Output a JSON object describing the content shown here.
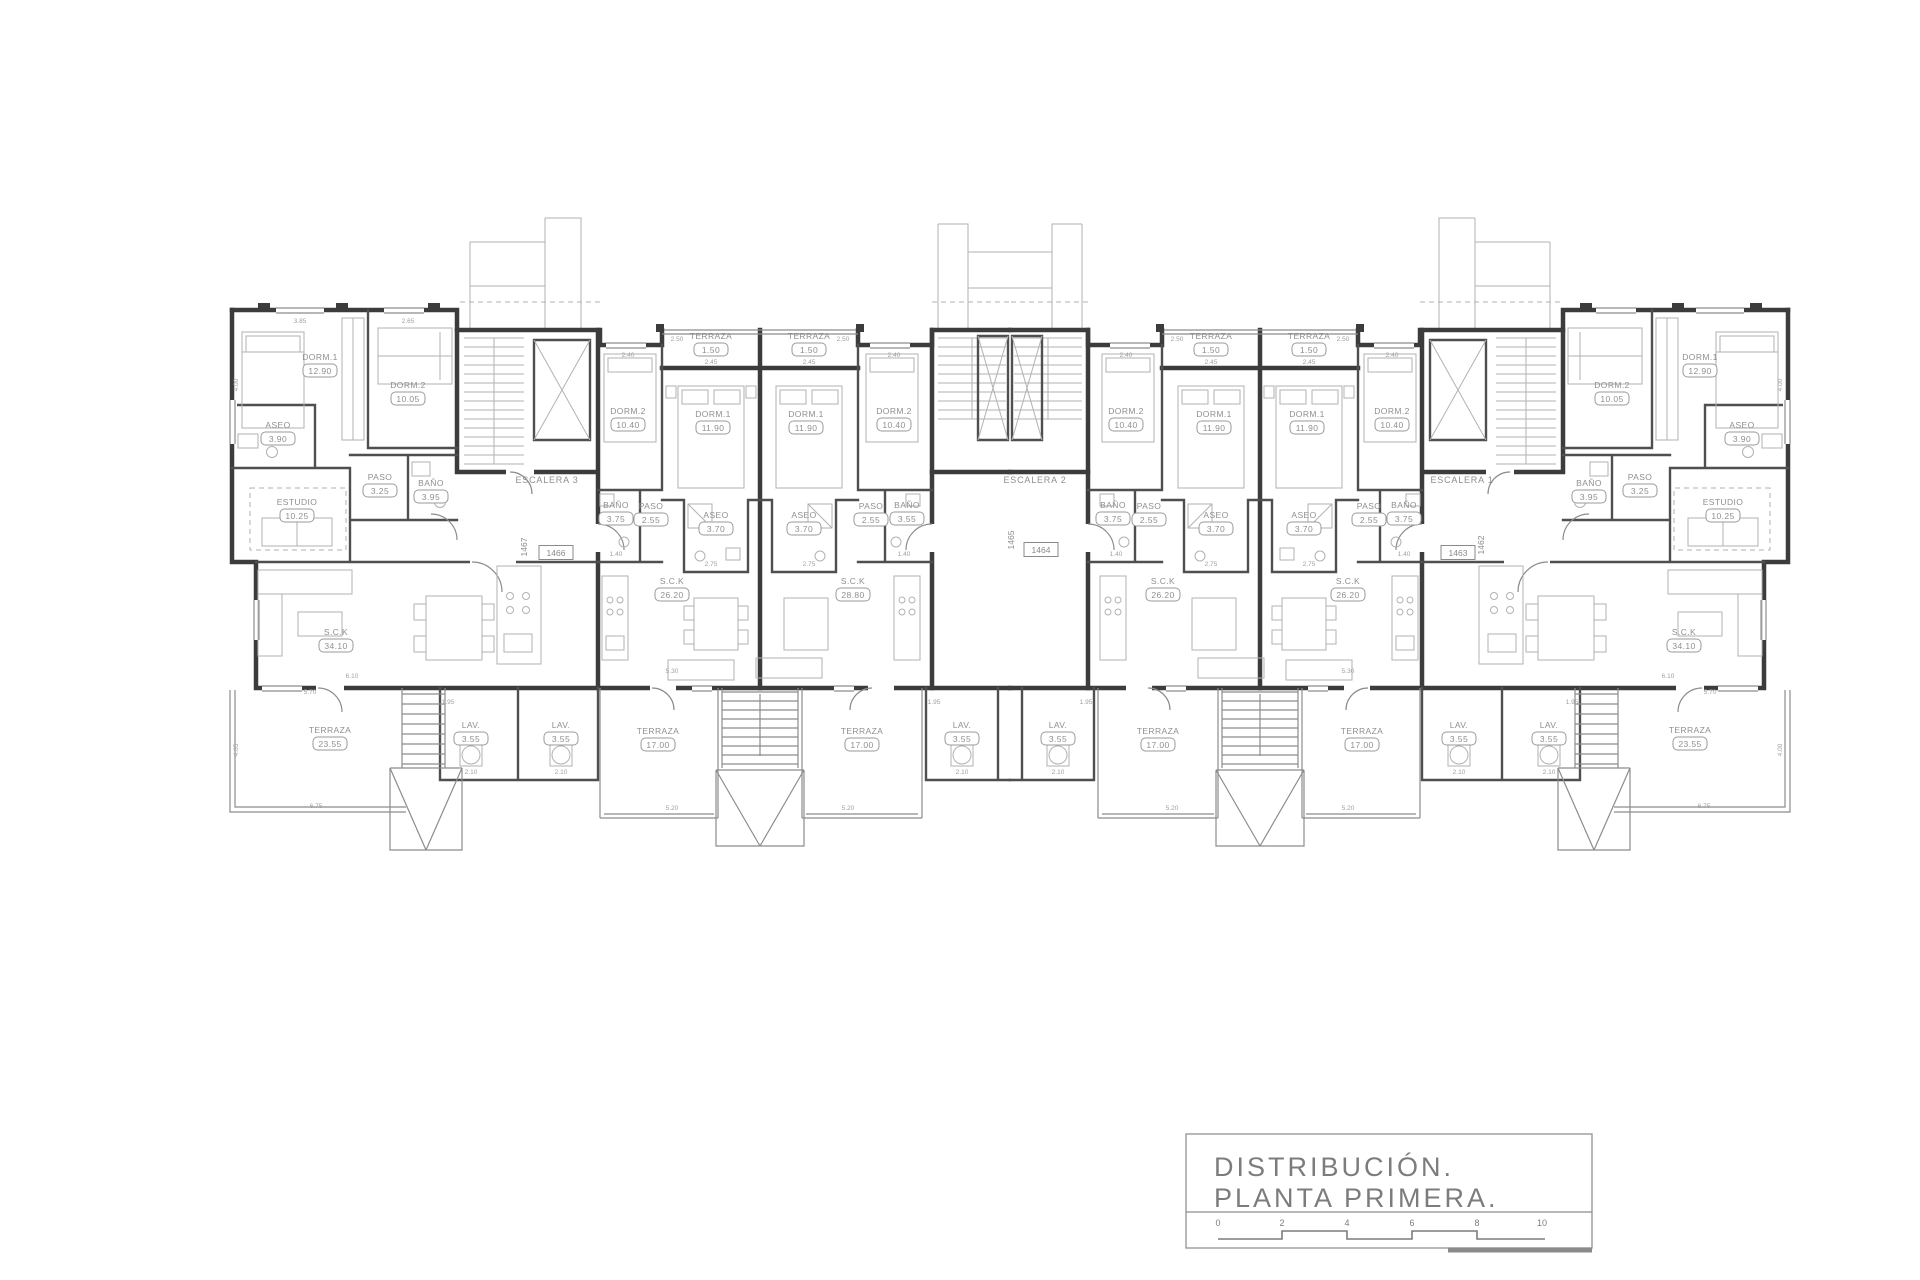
{
  "drawing": {
    "title": "DISTRIBUCIÓN.",
    "subtitle": "PLANTA  PRIMERA.",
    "scale_ticks": [
      "0",
      "2",
      "4",
      "6",
      "8",
      "10"
    ]
  },
  "stair_labels": [
    {
      "text": "ESCALERA 3",
      "x": 547,
      "y": 483
    },
    {
      "text": "ESCALERA 2",
      "x": 1035,
      "y": 483
    },
    {
      "text": "ESCALERA 1",
      "x": 1462,
      "y": 483
    }
  ],
  "unit_numbers": [
    {
      "text": "1467",
      "x": 527,
      "y": 547,
      "vertical": true,
      "boxed": false
    },
    {
      "text": "1466",
      "x": 556,
      "y": 556,
      "vertical": false,
      "boxed": true
    },
    {
      "text": "1465",
      "x": 1014,
      "y": 540,
      "vertical": true,
      "boxed": false
    },
    {
      "text": "1464",
      "x": 1041,
      "y": 553,
      "vertical": false,
      "boxed": true
    },
    {
      "text": "1463",
      "x": 1458,
      "y": 556,
      "vertical": false,
      "boxed": true
    },
    {
      "text": "1462",
      "x": 1484,
      "y": 545,
      "vertical": true,
      "boxed": false
    }
  ],
  "rooms": [
    {
      "unit": "1467",
      "name": "DORM.1",
      "area": "12.90",
      "x": 320,
      "y": 360
    },
    {
      "unit": "1467",
      "name": "DORM.2",
      "area": "10.05",
      "x": 408,
      "y": 388
    },
    {
      "unit": "1467",
      "name": "ASEO",
      "area": "3.90",
      "x": 278,
      "y": 428
    },
    {
      "unit": "1467",
      "name": "PASO",
      "area": "3.25",
      "x": 380,
      "y": 480
    },
    {
      "unit": "1467",
      "name": "BAÑO",
      "area": "3.95",
      "x": 431,
      "y": 486
    },
    {
      "unit": "1467",
      "name": "ESTUDIO",
      "area": "10.25",
      "x": 297,
      "y": 505
    },
    {
      "unit": "1467",
      "name": "S.C.K",
      "area": "34.10",
      "x": 336,
      "y": 635
    },
    {
      "unit": "1467",
      "name": "TERRAZA",
      "area": "23.55",
      "x": 330,
      "y": 733
    },
    {
      "unit": "1466",
      "name": "TERRAZA",
      "area": "1.50",
      "x": 711,
      "y": 339
    },
    {
      "unit": "1466",
      "name": "DORM.2",
      "area": "10.40",
      "x": 628,
      "y": 414
    },
    {
      "unit": "1466",
      "name": "DORM.1",
      "area": "11.90",
      "x": 713,
      "y": 417
    },
    {
      "unit": "1466",
      "name": "BAÑO",
      "area": "3.75",
      "x": 616,
      "y": 508
    },
    {
      "unit": "1466",
      "name": "PASO",
      "area": "2.55",
      "x": 651,
      "y": 509
    },
    {
      "unit": "1466",
      "name": "ASEO",
      "area": "3.70",
      "x": 716,
      "y": 518
    },
    {
      "unit": "1466",
      "name": "S.C.K",
      "area": "26.20",
      "x": 672,
      "y": 584
    },
    {
      "unit": "1466",
      "name": "TERRAZA",
      "area": "17.00",
      "x": 658,
      "y": 734
    },
    {
      "unit": "1465",
      "name": "TERRAZA",
      "area": "1.50",
      "x": 809,
      "y": 339
    },
    {
      "unit": "1465",
      "name": "DORM.1",
      "area": "11.90",
      "x": 806,
      "y": 417
    },
    {
      "unit": "1465",
      "name": "DORM.2",
      "area": "10.40",
      "x": 894,
      "y": 414
    },
    {
      "unit": "1465",
      "name": "ASEO",
      "area": "3.70",
      "x": 804,
      "y": 518
    },
    {
      "unit": "1465",
      "name": "PASO",
      "area": "2.55",
      "x": 871,
      "y": 509
    },
    {
      "unit": "1465",
      "name": "BAÑO",
      "area": "3.55",
      "x": 907,
      "y": 508
    },
    {
      "unit": "1465",
      "name": "S.C.K",
      "area": "28.80",
      "x": 853,
      "y": 584
    },
    {
      "unit": "1465",
      "name": "TERRAZA",
      "area": "17.00",
      "x": 862,
      "y": 734
    },
    {
      "unit": "1464",
      "name": "TERRAZA",
      "area": "1.50",
      "x": 1211,
      "y": 339
    },
    {
      "unit": "1464",
      "name": "DORM.2",
      "area": "10.40",
      "x": 1126,
      "y": 414
    },
    {
      "unit": "1464",
      "name": "DORM.1",
      "area": "11.90",
      "x": 1214,
      "y": 417
    },
    {
      "unit": "1464",
      "name": "BAÑO",
      "area": "3.75",
      "x": 1113,
      "y": 508
    },
    {
      "unit": "1464",
      "name": "PASO",
      "area": "2.55",
      "x": 1149,
      "y": 509
    },
    {
      "unit": "1464",
      "name": "ASEO",
      "area": "3.70",
      "x": 1216,
      "y": 518
    },
    {
      "unit": "1464",
      "name": "S.C.K",
      "area": "26.20",
      "x": 1163,
      "y": 584
    },
    {
      "unit": "1464",
      "name": "TERRAZA",
      "area": "17.00",
      "x": 1158,
      "y": 734
    },
    {
      "unit": "1463",
      "name": "TERRAZA",
      "area": "1.50",
      "x": 1309,
      "y": 339
    },
    {
      "unit": "1463",
      "name": "DORM.1",
      "area": "11.90",
      "x": 1307,
      "y": 417
    },
    {
      "unit": "1463",
      "name": "DORM.2",
      "area": "10.40",
      "x": 1392,
      "y": 414
    },
    {
      "unit": "1463",
      "name": "ASEO",
      "area": "3.70",
      "x": 1304,
      "y": 518
    },
    {
      "unit": "1463",
      "name": "PASO",
      "area": "2.55",
      "x": 1369,
      "y": 509
    },
    {
      "unit": "1463",
      "name": "BAÑO",
      "area": "3.75",
      "x": 1404,
      "y": 508
    },
    {
      "unit": "1463",
      "name": "S.C.K",
      "area": "26.20",
      "x": 1348,
      "y": 584
    },
    {
      "unit": "1463",
      "name": "TERRAZA",
      "area": "17.00",
      "x": 1362,
      "y": 734
    },
    {
      "unit": "1462",
      "name": "DORM.1",
      "area": "12.90",
      "x": 1700,
      "y": 360
    },
    {
      "unit": "1462",
      "name": "DORM.2",
      "area": "10.05",
      "x": 1612,
      "y": 388
    },
    {
      "unit": "1462",
      "name": "ASEO",
      "area": "3.90",
      "x": 1742,
      "y": 428
    },
    {
      "unit": "1462",
      "name": "PASO",
      "area": "3.25",
      "x": 1640,
      "y": 480
    },
    {
      "unit": "1462",
      "name": "BAÑO",
      "area": "3.95",
      "x": 1589,
      "y": 486
    },
    {
      "unit": "1462",
      "name": "ESTUDIO",
      "area": "10.25",
      "x": 1723,
      "y": 505
    },
    {
      "unit": "1462",
      "name": "S.C.K",
      "area": "34.10",
      "x": 1684,
      "y": 635
    },
    {
      "unit": "1462",
      "name": "TERRAZA",
      "area": "23.55",
      "x": 1690,
      "y": 733
    }
  ],
  "lavs": [
    {
      "name": "LAV.",
      "area": "3.55",
      "x": 471,
      "y": 728
    },
    {
      "name": "LAV.",
      "area": "3.55",
      "x": 561,
      "y": 728
    },
    {
      "name": "LAV.",
      "area": "3.55",
      "x": 962,
      "y": 728
    },
    {
      "name": "LAV.",
      "area": "3.55",
      "x": 1058,
      "y": 728
    },
    {
      "name": "LAV.",
      "area": "3.55",
      "x": 1459,
      "y": 728
    },
    {
      "name": "LAV.",
      "area": "3.55",
      "x": 1549,
      "y": 728
    }
  ],
  "dims": [
    {
      "text": "3.85",
      "x": 300,
      "y": 323,
      "vertical": false
    },
    {
      "text": "2.65",
      "x": 408,
      "y": 323,
      "vertical": false
    },
    {
      "text": "2.40",
      "x": 628,
      "y": 357,
      "vertical": false
    },
    {
      "text": "2.40",
      "x": 894,
      "y": 357,
      "vertical": false
    },
    {
      "text": "2.40",
      "x": 1126,
      "y": 357,
      "vertical": false
    },
    {
      "text": "2.40",
      "x": 1392,
      "y": 357,
      "vertical": false
    },
    {
      "text": "2.45",
      "x": 711,
      "y": 364,
      "vertical": false
    },
    {
      "text": "2.45",
      "x": 809,
      "y": 364,
      "vertical": false
    },
    {
      "text": "2.45",
      "x": 1211,
      "y": 364,
      "vertical": false
    },
    {
      "text": "2.45",
      "x": 1309,
      "y": 364,
      "vertical": false
    },
    {
      "text": "2.50",
      "x": 677,
      "y": 341,
      "vertical": false
    },
    {
      "text": "2.50",
      "x": 843,
      "y": 341,
      "vertical": false
    },
    {
      "text": "2.50",
      "x": 1177,
      "y": 341,
      "vertical": false
    },
    {
      "text": "2.50",
      "x": 1343,
      "y": 341,
      "vertical": false
    },
    {
      "text": "4.00",
      "x": 238,
      "y": 385,
      "vertical": true
    },
    {
      "text": "4.00",
      "x": 1782,
      "y": 385,
      "vertical": true
    },
    {
      "text": "4.05",
      "x": 238,
      "y": 750,
      "vertical": true
    },
    {
      "text": "4.00",
      "x": 1782,
      "y": 750,
      "vertical": true
    },
    {
      "text": "6.10",
      "x": 352,
      "y": 678,
      "vertical": false
    },
    {
      "text": "6.10",
      "x": 1668,
      "y": 678,
      "vertical": false
    },
    {
      "text": "5.70",
      "x": 310,
      "y": 694,
      "vertical": false
    },
    {
      "text": "5.70",
      "x": 1710,
      "y": 694,
      "vertical": false
    },
    {
      "text": "6.75",
      "x": 316,
      "y": 808,
      "vertical": false
    },
    {
      "text": "6.75",
      "x": 1704,
      "y": 808,
      "vertical": false
    },
    {
      "text": "5.20",
      "x": 672,
      "y": 810,
      "vertical": false
    },
    {
      "text": "5.20",
      "x": 848,
      "y": 810,
      "vertical": false
    },
    {
      "text": "5.20",
      "x": 1172,
      "y": 810,
      "vertical": false
    },
    {
      "text": "5.20",
      "x": 1348,
      "y": 810,
      "vertical": false
    },
    {
      "text": "2.10",
      "x": 471,
      "y": 774,
      "vertical": false
    },
    {
      "text": "2.10",
      "x": 561,
      "y": 774,
      "vertical": false
    },
    {
      "text": "2.10",
      "x": 962,
      "y": 774,
      "vertical": false
    },
    {
      "text": "2.10",
      "x": 1058,
      "y": 774,
      "vertical": false
    },
    {
      "text": "2.10",
      "x": 1459,
      "y": 774,
      "vertical": false
    },
    {
      "text": "2.10",
      "x": 1549,
      "y": 774,
      "vertical": false
    },
    {
      "text": "1.95",
      "x": 448,
      "y": 704,
      "vertical": false
    },
    {
      "text": "1.95",
      "x": 934,
      "y": 704,
      "vertical": false
    },
    {
      "text": "1.95",
      "x": 1086,
      "y": 704,
      "vertical": false
    },
    {
      "text": "1.95",
      "x": 1572,
      "y": 704,
      "vertical": false
    },
    {
      "text": "2.75",
      "x": 711,
      "y": 566,
      "vertical": false
    },
    {
      "text": "2.75",
      "x": 809,
      "y": 566,
      "vertical": false
    },
    {
      "text": "2.75",
      "x": 1211,
      "y": 566,
      "vertical": false
    },
    {
      "text": "2.75",
      "x": 1309,
      "y": 566,
      "vertical": false
    },
    {
      "text": "1.40",
      "x": 616,
      "y": 556,
      "vertical": false
    },
    {
      "text": "1.40",
      "x": 904,
      "y": 556,
      "vertical": false
    },
    {
      "text": "1.40",
      "x": 1116,
      "y": 556,
      "vertical": false
    },
    {
      "text": "1.40",
      "x": 1404,
      "y": 556,
      "vertical": false
    },
    {
      "text": "5.30",
      "x": 672,
      "y": 673,
      "vertical": false
    },
    {
      "text": "5.30",
      "x": 1348,
      "y": 673,
      "vertical": false
    }
  ]
}
